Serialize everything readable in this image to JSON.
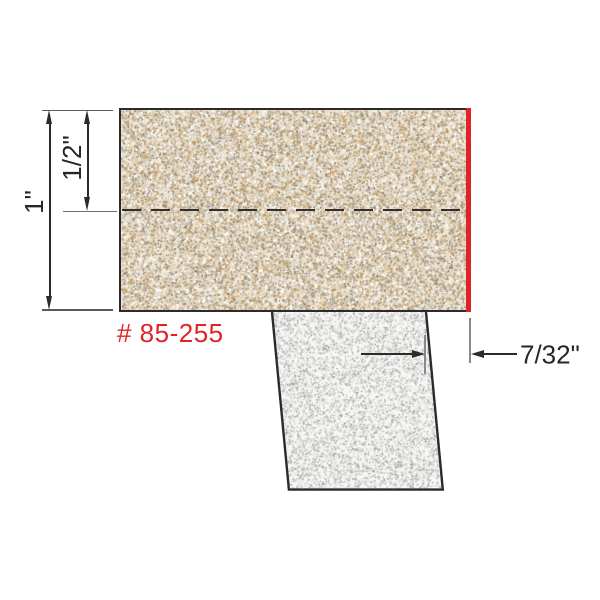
{
  "diagram": {
    "title": "edge-trim-bit-profile-diagram",
    "part_number": "# 85-255",
    "dimensions": {
      "overall_thickness": "1\"",
      "centerline_depth": "1/2\"",
      "trim_offset": "7/32\""
    },
    "colors": {
      "accent_red": "#e02329",
      "line_ink": "#2b2b2b",
      "extension_gray": "#8a8a8a",
      "laminate_base": "#eae2d2",
      "shank_base": "#f7f7f5"
    },
    "materials": {
      "laminate_speckles": [
        {
          "color": "#ffffff",
          "w": 20,
          "min": 0.8,
          "max": 2.2
        },
        {
          "color": "#dccfb6",
          "w": 16,
          "min": 0.8,
          "max": 2.4
        },
        {
          "color": "#c59f67",
          "w": 14,
          "min": 0.8,
          "max": 2.2
        },
        {
          "color": "#ad8752",
          "w": 8,
          "min": 0.8,
          "max": 1.9
        },
        {
          "color": "#a39d8e",
          "w": 13,
          "min": 0.8,
          "max": 2.1
        },
        {
          "color": "#7e776a",
          "w": 9,
          "min": 0.7,
          "max": 1.7
        },
        {
          "color": "#5b564d",
          "w": 5,
          "min": 0.6,
          "max": 1.4
        },
        {
          "color": "#e0b57e",
          "w": 6,
          "min": 0.8,
          "max": 2.0
        },
        {
          "color": "#c7c2b6",
          "w": 9,
          "min": 0.8,
          "max": 2.2
        }
      ],
      "laminate_dot_count": 26000,
      "shank_speckles": [
        {
          "color": "#c9c9c7",
          "w": 26,
          "min": 0.7,
          "max": 1.8
        },
        {
          "color": "#b5b5b3",
          "w": 22,
          "min": 0.7,
          "max": 1.7
        },
        {
          "color": "#9d9d9b",
          "w": 18,
          "min": 0.7,
          "max": 1.6
        },
        {
          "color": "#89898a",
          "w": 10,
          "min": 0.6,
          "max": 1.4
        },
        {
          "color": "#707070",
          "w": 5,
          "min": 0.6,
          "max": 1.2
        },
        {
          "color": "#e3e3e1",
          "w": 19,
          "min": 0.8,
          "max": 2.0
        }
      ],
      "shank_dot_count": 8200
    }
  }
}
